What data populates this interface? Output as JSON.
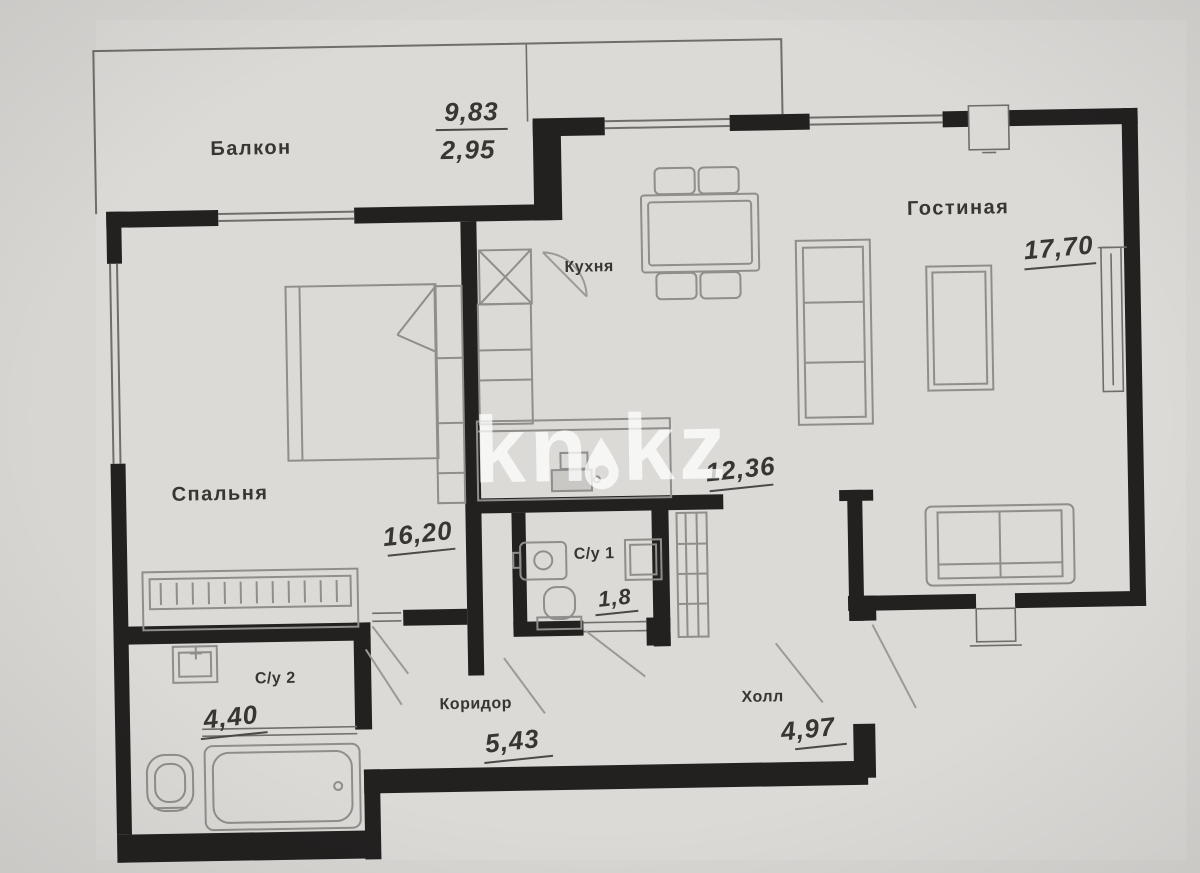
{
  "plan": {
    "watermark": {
      "left": "kn",
      "right": "kz"
    },
    "rooms": {
      "balcony": {
        "label": "Балкон",
        "area_total": "9,83",
        "area_reduced": "2,95"
      },
      "kitchen": {
        "label": "Кухня",
        "area": "12,36"
      },
      "living": {
        "label": "Гостиная",
        "area": "17,70"
      },
      "bedroom": {
        "label": "Спальня",
        "area": "16,20"
      },
      "bath1": {
        "label": "С/у 1",
        "area": "1,8"
      },
      "bath2": {
        "label": "С/у 2",
        "area": "4,40"
      },
      "corridor": {
        "label": "Коридор",
        "area": "5,43"
      },
      "hall": {
        "label": "Холл",
        "area": "4,97"
      }
    },
    "colors": {
      "paper": "#d8d6d3",
      "wall": "#222120",
      "line": "#6f6e6b",
      "furniture": "#8f8e8b",
      "text": "#373633",
      "watermark": "rgba(255,255,255,0.75)"
    }
  }
}
